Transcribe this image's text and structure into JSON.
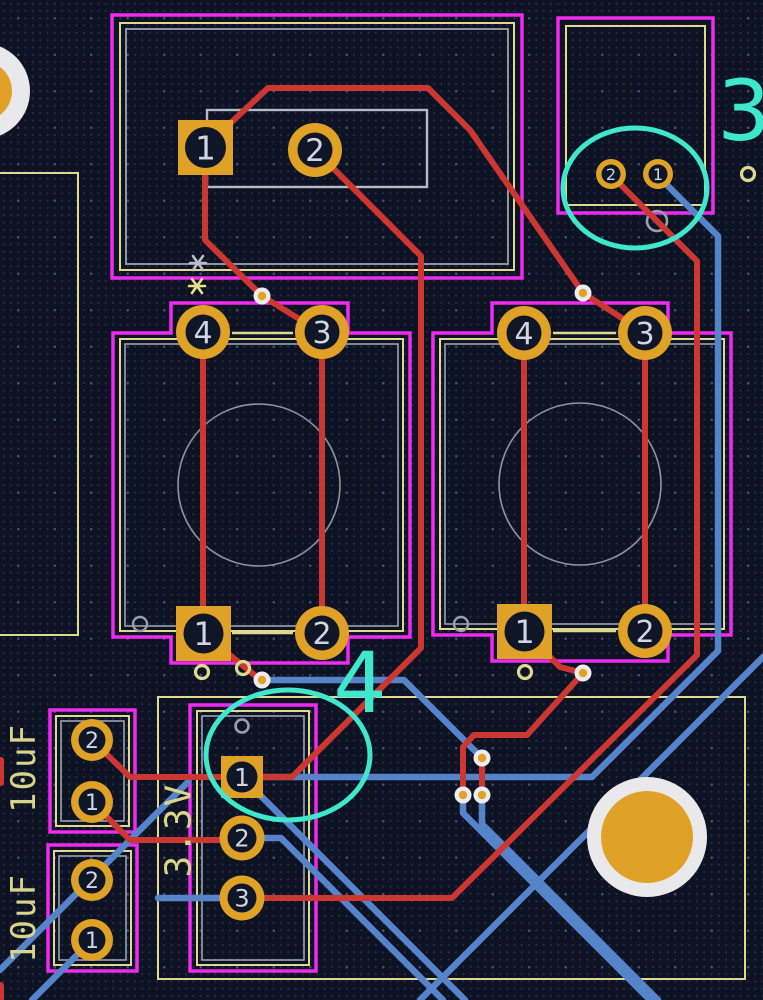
{
  "app": {
    "title": "PCB layout canvas"
  },
  "pcb": {
    "silkscreen_labels": {
      "cap_top": "10uF",
      "cap_bottom": "10uF",
      "rail": "3.3V"
    },
    "annotations": {
      "callout_top_right": "3",
      "callout_bottom": "4"
    },
    "pads": {
      "tl_conn_1": "1",
      "tl_conn_2": "2",
      "tr_conn_1": "1",
      "tr_conn_2": "2",
      "sw_left_1": "1",
      "sw_left_2": "2",
      "sw_left_3": "3",
      "sw_left_4": "4",
      "sw_right_1": "1",
      "sw_right_2": "2",
      "sw_right_3": "3",
      "sw_right_4": "4",
      "header_1": "1",
      "header_2": "2",
      "header_3": "3",
      "cap_top_1": "1",
      "cap_top_2": "2",
      "cap_bottom_1": "1",
      "cap_bottom_2": "2"
    },
    "colors": {
      "background": "#0d1323",
      "copper_front_red": "#cc3732",
      "copper_back_blue": "#5584ca",
      "courtyard_magenta": "#ef2bef",
      "fab_cream": "#ded98f",
      "silk_gray": "#a8b0bc",
      "pad_gold": "#dfa227",
      "via_ring_white": "#ececee",
      "annotation_cyan": "#3fe7cd",
      "numeral": "#cfd6e0"
    }
  }
}
